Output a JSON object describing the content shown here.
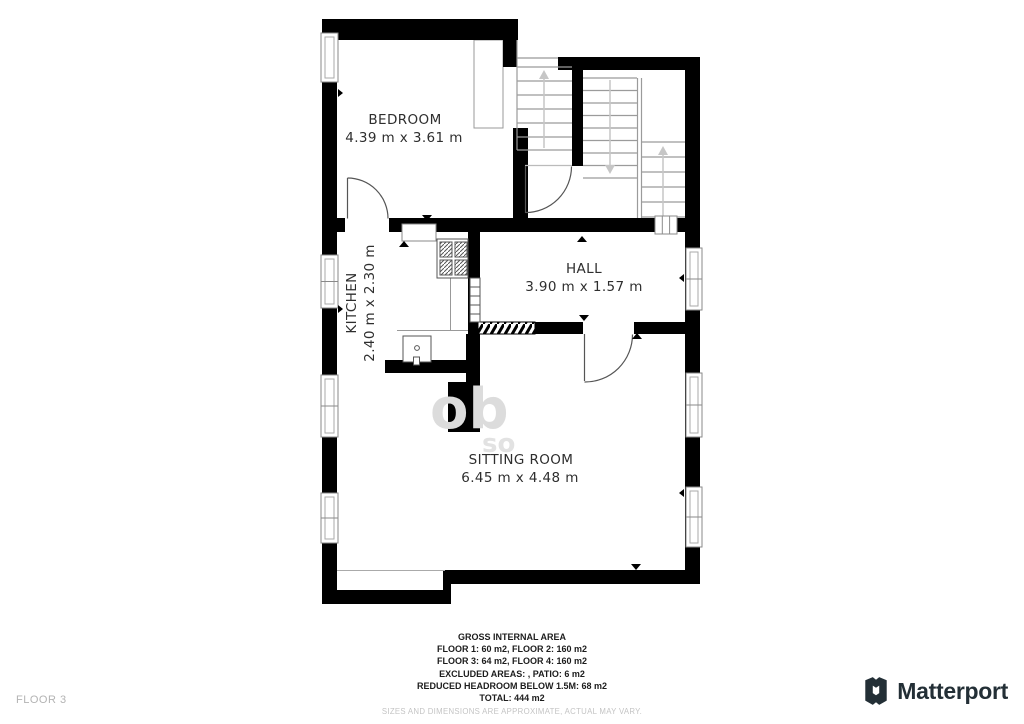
{
  "floorplan": {
    "rooms": [
      {
        "name": "BEDROOM",
        "dims": "4.39 m x 3.61 m"
      },
      {
        "name": "KITCHEN",
        "dims": "2.40 m x 2.30 m"
      },
      {
        "name": "HALL",
        "dims": "3.90 m x 1.57 m"
      },
      {
        "name": "SITTING ROOM",
        "dims": "6.45 m x 4.48 m"
      }
    ],
    "watermark_fragments": {
      "big": "ob",
      "small": "so"
    }
  },
  "footer": {
    "title": "GROSS INTERNAL AREA",
    "lines": [
      "FLOOR 1: 60 m2, FLOOR 2: 160 m2",
      "FLOOR 3: 64 m2, FLOOR 4: 160 m2",
      "EXCLUDED AREAS: , PATIO: 6 m2",
      "REDUCED HEADROOM BELOW 1.5M: 68 m2",
      "TOTAL: 444 m2"
    ],
    "disclaimer": "SIZES AND DIMENSIONS ARE APPROXIMATE, ACTUAL MAY VARY."
  },
  "floor_label": "FLOOR 3",
  "brand": {
    "name": "Matterport",
    "logo_icon": "matterport-m-icon"
  },
  "colors": {
    "wall": "#000000",
    "stair_line": "#9b9b9b",
    "arrow": "#c6c6c6",
    "label_text": "#2e2e2e",
    "footer_text": "#1c1c1c",
    "muted_text": "#c4c4c4",
    "floor_label_text": "#b3b3b3",
    "brand_text": "#232f36"
  }
}
